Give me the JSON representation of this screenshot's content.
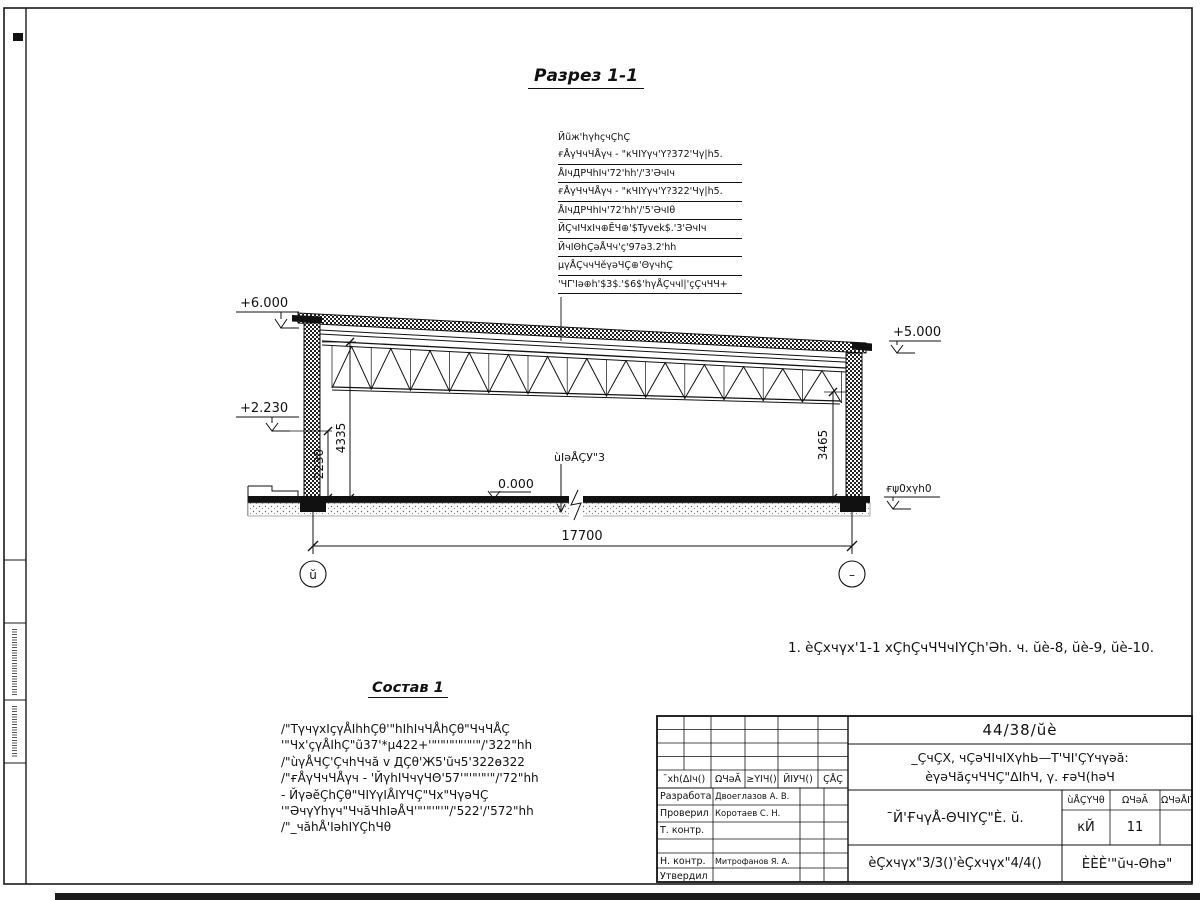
{
  "drawing": {
    "title": "Разрез 1-1",
    "note": "1. èÇxчγx'1-1 xÇhÇчЧЧчIҮÇh'Әh. ч. ŭè-8, ŭè-9, ŭè-10.",
    "callout": {
      "header": "Йũж'hγhçчÇhÇ",
      "rows": [
        "ғÅγЧчЧÅγч - \"кЧIҮγч'Ү?372'Чγ|h5.",
        "ÅIчДРЧhIч'72'hh'/'3'ӘчIч",
        "ғÅγЧчЧÅγч - \"кЧIҮγч'Ү?322'Чγ|h5.",
        "ÅIчДРЧhIч'72'hh'/'5'ӘчIθ",
        "ЙÇчIЧxIч⊕ÊЧ⊕'$Tyvek$.'3'ӘчIч",
        "ЙчIΘhÇәÅЧч'ç'97ә3.2'hh",
        "μγÅÇччЧĕγәЧÇ⊕'ΘγчhÇ",
        "'ЧΓ'Iә⊕h'$3$.'$6$'hγÅÇччl|'çÇчЧЧ+"
      ]
    },
    "elevations": {
      "plus6": "+6.000",
      "plus5": "+5.000",
      "plus2": "+2.230",
      "zero": "0.000",
      "ground_right": "ғψ0xγh0",
      "floor_label": "ùIәÅÇУ\"3"
    },
    "dims": {
      "v1": "2230",
      "v2": "4335",
      "v3": "3465",
      "span": "17700"
    },
    "axes": {
      "left": "ŭ",
      "right": "–"
    },
    "sostav": {
      "title": "Состав 1",
      "lines": [
        "/\"ТγчγxIçγÅIhhÇθ'\"hIhIчЧÅhÇθ\"ЧчЧÅÇ",
        "'\"Чx'çγÅIhÇ\"ũ37'*μ422+'\"'\"'\"'\"'\"'\"/'322\"hh",
        "/\"ùγÅЧÇ'ÇчhЧчă v ДÇθ'Ж5'ũч5'322ө322",
        "/\"ғÅγЧчЧÅγч - 'ЙγhIЧчγЧΘ'57'\"'\"'\"'\"/'72\"hh",
        "- ЙγәĕÇhÇθ\"ЧIҮγIÅIҮЧÇ\"Чx\"ЧγәЧÇ",
        "'\"ӘчγҮhγч\"ЧчăЧhIәÅЧ'\"'\"'\"'\"/'522'/'572\"hh",
        "/\"_чăhÅ'IәhIҮÇhЧθ"
      ]
    }
  },
  "stamp": {
    "doc_number": "44/38/ŭè",
    "change_headers": [
      "¯xh(ΔIч()",
      "ΩЧәĂ",
      "≥ҮIЧ()",
      "ЙIУЧ()",
      "ÇÅÇ"
    ],
    "rows": [
      {
        "label": "Разработал",
        "name": "Двоеглазов А. В."
      },
      {
        "label": "Проверил",
        "name": "Коротаев С. Н."
      },
      {
        "label": "Т. контр.",
        "name": ""
      },
      {
        "label": "Н. контр.",
        "name": "Митрофанов Я. А."
      },
      {
        "label": "Утвердил",
        "name": ""
      }
    ],
    "project_line1": "_ÇчÇX, чÇәЧIчIXγhЬ—Т'ЧI'ÇҮчγәă:",
    "project_line2": "èγәЧăçчЧЧÇ\"ΔIhЧ, γ. ғәЧ(hәЧ",
    "sheet_title": "¯Й'ҒчγÅ-ΘЧIҮÇ\"È. ŭ.",
    "mini_headers": [
      "ùÅÇҮЧθ",
      "ΩЧәĂ",
      "ΩЧәÅIҮ"
    ],
    "mini_values": [
      "кЙ",
      "11"
    ],
    "bottom_center": "èÇxчγx\"3/3()'èÇxчγx\"4/4()",
    "bottom_right": "ÈÈÈ'\"ŭч-Θhә\""
  }
}
